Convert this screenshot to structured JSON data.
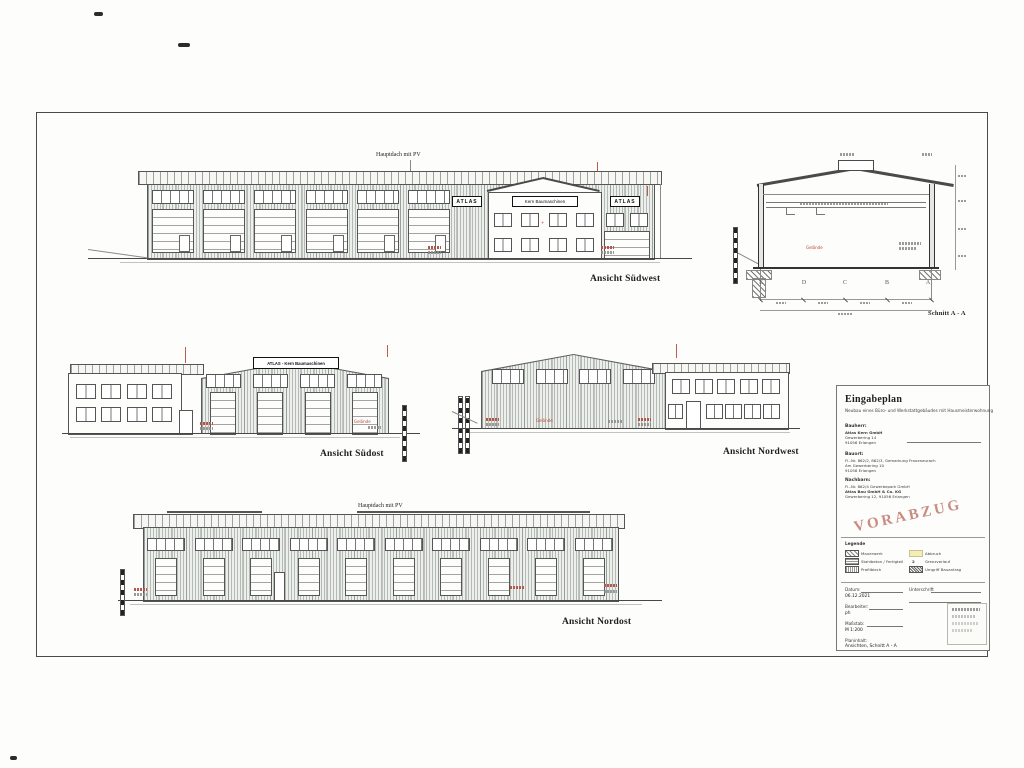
{
  "captions": {
    "suedwest": "Ansicht Südwest",
    "suedost": "Ansicht Südost",
    "nordwest": "Ansicht Nordwest",
    "nordost": "Ansicht Nordost",
    "schnitt": "Schnitt A - A"
  },
  "labels": {
    "hauptdach": "Hauptdach mit PV",
    "atlas": "ATLAS",
    "kern_sign": "Kern Baumaschinen",
    "atlas_kern": "ATLAS - Kern Baumaschinen",
    "gelaende": "Gelände",
    "grid": [
      "E",
      "D",
      "C",
      "B",
      "A"
    ]
  },
  "structure": {
    "sw_bays": 6,
    "no_bays": 10,
    "so_bands": 4,
    "so_doors": 4,
    "nw_bands": 4,
    "sw_office_windows": 4,
    "so_office_windows": 4,
    "nw_office_row1": 5,
    "nw_office_row2": 4
  },
  "titleblock": {
    "title": "Eingabeplan",
    "subtitle": "Neubau eines Büro- und Werkstattgebäudes mit Hausmeisterwohnung",
    "bauherr_label": "Bauherr:",
    "bauherr_lines": [
      "Atlas Kern GmbH",
      "Gewerbering 14",
      "91056 Erlangen"
    ],
    "bauort_label": "Bauort:",
    "bauort_lines": [
      "Fl.-Nr. 862/2, 862/3, Gemarkung Frauenaurach",
      "Am Gewerbering 10",
      "91056 Erlangen"
    ],
    "nachbarn_label": "Nachbarn:",
    "nachbarn_lines": [
      "Fl.-Nr. 862/4 Gewerbepark GmbH",
      "Atlas Bau GmbH & Co. KG",
      "Gewerbering 12, 91056 Erlangen"
    ],
    "stamp": "VORABZUG",
    "legende_label": "Legende",
    "legend_left": [
      "Mauerwerk",
      "Stahlbeton / Fertigteil",
      "Profilblech"
    ],
    "legend_right": [
      "Abbruch",
      "Grenzverlauf",
      "Umgriff Bauantrag"
    ],
    "legend_symbol": "2",
    "datum_label": "Datum:",
    "datum_value": "06.12.2021",
    "bearbeiter_label": "Bearbeiter:",
    "bearbeiter_value": "ph",
    "massstab_label": "Maßstab:",
    "massstab_value": "M 1:200",
    "unterschrift_label": "Unterschrift",
    "planinhalt_label": "Planinhalt:",
    "planinhalt_value": "Ansichten, Schnitt A - A"
  },
  "colors": {
    "annotation_red": "#b5443a",
    "stamp_pink": "#bb6a60",
    "legend_yellow": "#f3edba"
  }
}
